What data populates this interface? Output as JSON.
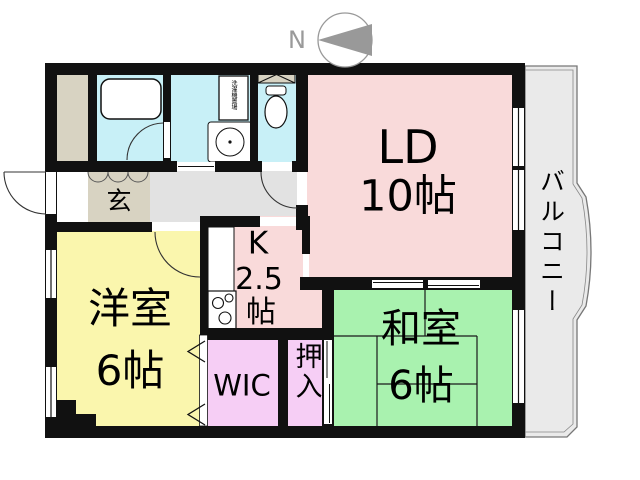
{
  "plan": {
    "compass_label": "N",
    "rooms": {
      "living_dining": {
        "name": "LD",
        "size": "10帖"
      },
      "western_room": {
        "name": "洋室",
        "size": "6帖"
      },
      "japanese_room": {
        "name": "和室",
        "size": "6帖"
      },
      "kitchen": {
        "name": "K",
        "size": "2.5",
        "unit": "帖"
      },
      "walk_in_closet": {
        "name": "WIC"
      },
      "oshiire_closet": {
        "name": "押入"
      },
      "entrance": {
        "name": "玄"
      },
      "balcony": {
        "name": "バルコニー"
      },
      "laundry_space": {
        "name": "洗濯機置場"
      }
    },
    "colors": {
      "living_dining": "#f9dada",
      "kitchen": "#f9dada",
      "western_room": "#faf6ad",
      "japanese_room": "#a9f2af",
      "closets": "#f6cef5",
      "wet_area": "#c8f0f7",
      "hallway": "#e2e2e2",
      "balcony": "#eaeaea",
      "entrance_floor": "#d8d3c2",
      "wall": "#111111"
    }
  }
}
